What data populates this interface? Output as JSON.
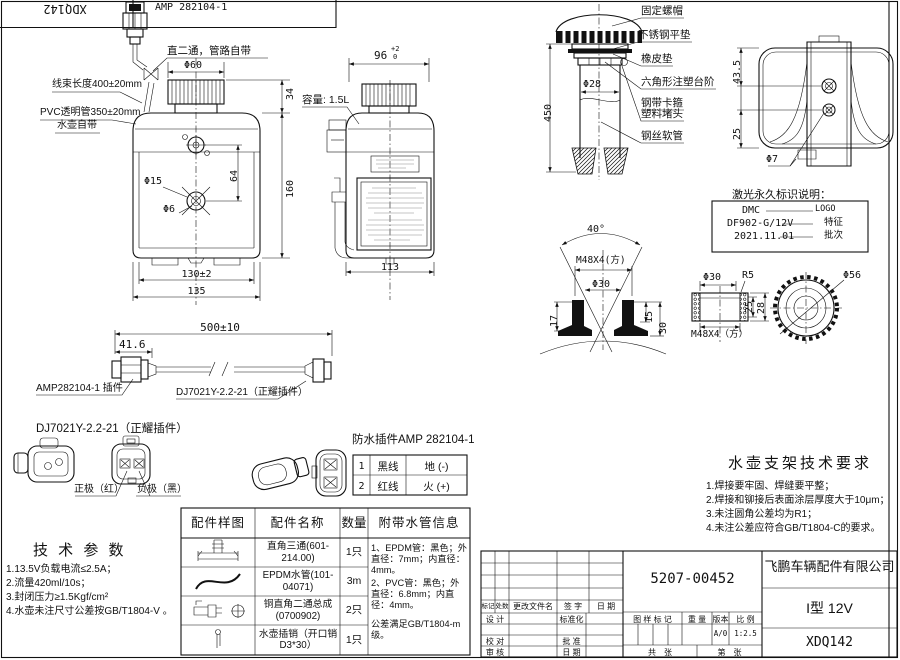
{
  "sheet": {
    "corner_code": "XDQ142"
  },
  "front": {
    "amp": "AMP 282104-1",
    "tee": "直二通，管路自带",
    "harness": "线束长度400±20mm",
    "pvc": "PVC透明管350±20mm",
    "own": "水壶自带",
    "d60": "Φ60",
    "d34": "34",
    "d160": "160",
    "d64": "64",
    "d15": "Φ15",
    "d6": "Φ6",
    "w130": "130±2",
    "w135": "135"
  },
  "side": {
    "w96": "96",
    "tol_up": "+2",
    "tol_dn": "0",
    "capacity": "容量: 1.5L",
    "w113": "113"
  },
  "strainer": {
    "labels": [
      "固定螺帽",
      "不锈钢平垫",
      "橡皮垫",
      "六角形注塑台阶",
      "钢带卡箍",
      "塑料堵头",
      "钢丝软管"
    ],
    "d28": "Φ28",
    "len": "450"
  },
  "top": {
    "d435": "43.5",
    "d25": "25",
    "d7": "Φ7"
  },
  "laser": {
    "title": "激光永久标识说明：",
    "rows": [
      {
        "value": "DMC",
        "meaning": "LOGO"
      },
      {
        "value": "DF902-G/12V",
        "meaning": "特征"
      },
      {
        "value": "2021.11.01",
        "meaning": "批次"
      }
    ]
  },
  "neck": {
    "a40": "40°",
    "thread": "M48X4(方)",
    "d30": "Φ30",
    "d17": "17",
    "d15": "15",
    "d30b": "30"
  },
  "cap": {
    "d30": "Φ30",
    "r5": "R5",
    "thread": "M48X4（方）",
    "d25": "25",
    "d28": "28",
    "d56": "Φ56"
  },
  "cable": {
    "total": "500±10",
    "len": "41.6",
    "left": "AMP282104-1 插件",
    "right": "DJ7021Y-2.2-21（正耀插件）"
  },
  "dj": {
    "title": "DJ7021Y-2.2-21（正耀插件）",
    "pos": "正极（红）",
    "neg": "负极（黑）"
  },
  "amp": {
    "title": "防水插件AMP 282104-1",
    "pins": [
      {
        "no": "1",
        "wire": "黑线",
        "fn": "地 (-)"
      },
      {
        "no": "2",
        "wire": "红线",
        "fn": "火 (+)"
      }
    ]
  },
  "tech": {
    "title": "技 术 参 数",
    "items": [
      "1.13.5V负载电流≤2.5A；",
      "2.流量420ml/10s；",
      "3.封闭压力≥1.5Kgf/cm²",
      "4.水壶未注尺寸公差按GB/T1804-V 。"
    ]
  },
  "bracket": {
    "title": "水壶支架技术要求",
    "items": [
      "1.焊接要牢固、焊缝要平整；",
      "2.焊接和铆接后表面涂层厚度大于10μm；",
      "3.未注圆角公差均为R1；",
      "4.未注公差应符合GB/T1804-C的要求。"
    ]
  },
  "parts": {
    "headers": [
      "配件样图",
      "配件名称",
      "数量",
      "附带水管信息"
    ],
    "rows": [
      {
        "icon": "tee-fitting-icon",
        "name": "直角三通(601-214.00)",
        "qty": "1只"
      },
      {
        "icon": "hose-icon",
        "name": "EPDM水管(101-04071)",
        "qty": "3m"
      },
      {
        "icon": "elbow-fitting-icon",
        "name": "铜直角二通总成 (0700902)",
        "qty": "2只"
      },
      {
        "icon": "pin-icon",
        "name": "水壶插销（开口销 D3*30）",
        "qty": "1只"
      }
    ],
    "info": [
      "1、EPDM管：黑色；外直径：7mm；内直径：4mm。",
      "2、PVC管：黑色；外直径：6.8mm；内直径：4mm。",
      "公差满足GB/T1804-m级。"
    ]
  },
  "tb": {
    "part_number": "5207-00452",
    "company": "飞鹏车辆配件有限公司",
    "model": "I型 12V",
    "drawing_no": "XDQ142",
    "version_value": "A/0",
    "scale_value": "1:2.5",
    "rev_h1": "标记",
    "rev_h2": "处数",
    "rev_h3": "更改文件名",
    "rev_h4": "签 字",
    "rev_h5": "日 期",
    "f_design": "设 计",
    "f_standard": "标准化",
    "f_check": "校 对",
    "f_approve": "批 准",
    "f_review": "审 核",
    "f_date": "日 期",
    "f_mark": "图 样 标 记",
    "f_weight": "重 量",
    "f_version": "版本",
    "f_scale": "比 例",
    "f_sheets": "共　张",
    "f_sheet_no": "第　张"
  }
}
